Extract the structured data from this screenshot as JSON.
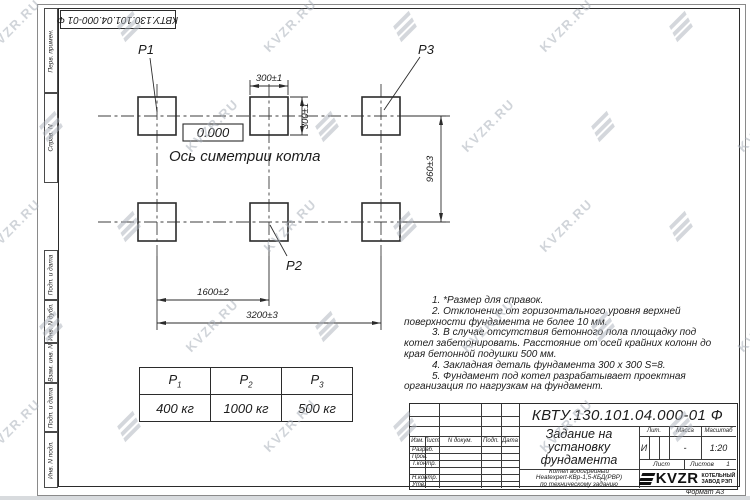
{
  "designation": "КВТУ.130.101.04.000-01 Ф",
  "sidebar": {
    "items": [
      "Перв. примен.",
      "Справ. N",
      "Подп. и дата",
      "Инв. N дубл.",
      "Взам. инв. N",
      "Подп. и дата",
      "Инв. N подл."
    ]
  },
  "drawing": {
    "labels": {
      "p1": "P1",
      "p2": "P2",
      "p3": "P3"
    },
    "elevation": "0.000",
    "axis_label": "Ось симетрии котла",
    "dims": {
      "top_width": "300±1",
      "top_height": "300±1",
      "rows_gap": "960±3",
      "col_pitch": "1600±2",
      "total_width": "3200±3"
    }
  },
  "load_table": {
    "headers": [
      {
        "label": "P",
        "sub": "1"
      },
      {
        "label": "P",
        "sub": "2"
      },
      {
        "label": "P",
        "sub": "3"
      }
    ],
    "values": [
      "400 кг",
      "1000 кг",
      "500 кг"
    ]
  },
  "notes": [
    "1. *Размер для справок.",
    "2. Отклонение от горизонтального уровня верхней поверхности фундамента не более 10 мм.",
    "3. В случае отсутствия бетонного пола площадку под котел забетонировать. Расстояние от осей крайних колонн до края бетонной подушки 500 мм.",
    "4. Закладная деталь фундамента 300 x 300 S=8.",
    "5. Фундамент под котел разрабатывает проектная организация по нагрузкам на фундамент."
  ],
  "title_block": {
    "headers": [
      "Изм.",
      "Лист",
      "N докум.",
      "Подп.",
      "Дата"
    ],
    "rows": [
      "Разраб.",
      "Пров.",
      "Т.контр.",
      "",
      "Н.контр.",
      "Утв."
    ],
    "title_lines": [
      "Задание на",
      "установку",
      "фундамента"
    ],
    "subtitle_lines": [
      "Котел водогрейный",
      "Heatexpert-КВр-1,5-КБД(РВР)",
      "по техническому заданию"
    ],
    "lit_label": "Лит.",
    "lit_value": "И",
    "mass_label": "Масса",
    "mass_value": "-",
    "scale_label": "Масштаб",
    "scale_value": "1:20",
    "sheet_label": "Лист",
    "sheets_label": "Листов",
    "sheets_value": "1",
    "logo_text": "KVZR",
    "logo_caption_lines": [
      "КОТЕЛЬНЫЙ",
      "ЗАВОД РЭП"
    ],
    "format": "Формат А3"
  },
  "watermark": {
    "text": "KVZR.RU"
  },
  "colors": {
    "line": "#2b2b2b",
    "watermark": "#aab1bb"
  }
}
